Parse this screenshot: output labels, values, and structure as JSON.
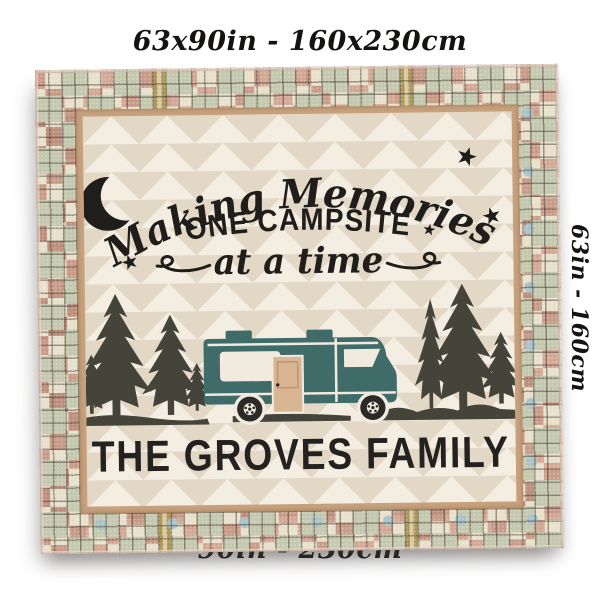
{
  "product": {
    "dimensions": {
      "top": "63x90in - 160x230cm",
      "side": "63in - 160cm",
      "bottom": "90in - 230cm"
    },
    "blanket": {
      "quote": {
        "line1": "Making Memories",
        "line2": "ONE CAMPSITE",
        "line3": "at a time"
      },
      "family_name": "THE GROVES FAMILY"
    },
    "colors": {
      "rv_body": "#3f6c68",
      "rv_door": "#d8b593",
      "trim_cream": "#f1ebdf",
      "tree_and_ground": "#45443a",
      "chevron_light": "#f3ede2",
      "chevron_dark": "#e3d8c6",
      "border_salmon": "#c89b88",
      "border_sage": "#c3c8ae",
      "border_cream": "#e7e0cb",
      "border_blue": "#a9c2c8",
      "frame_tan": "#c7a17d",
      "text": "#1f1e1b"
    },
    "icons": [
      "crescent-moon-icon",
      "star-icon",
      "pine-tree-icon",
      "rv-camper-icon"
    ]
  }
}
